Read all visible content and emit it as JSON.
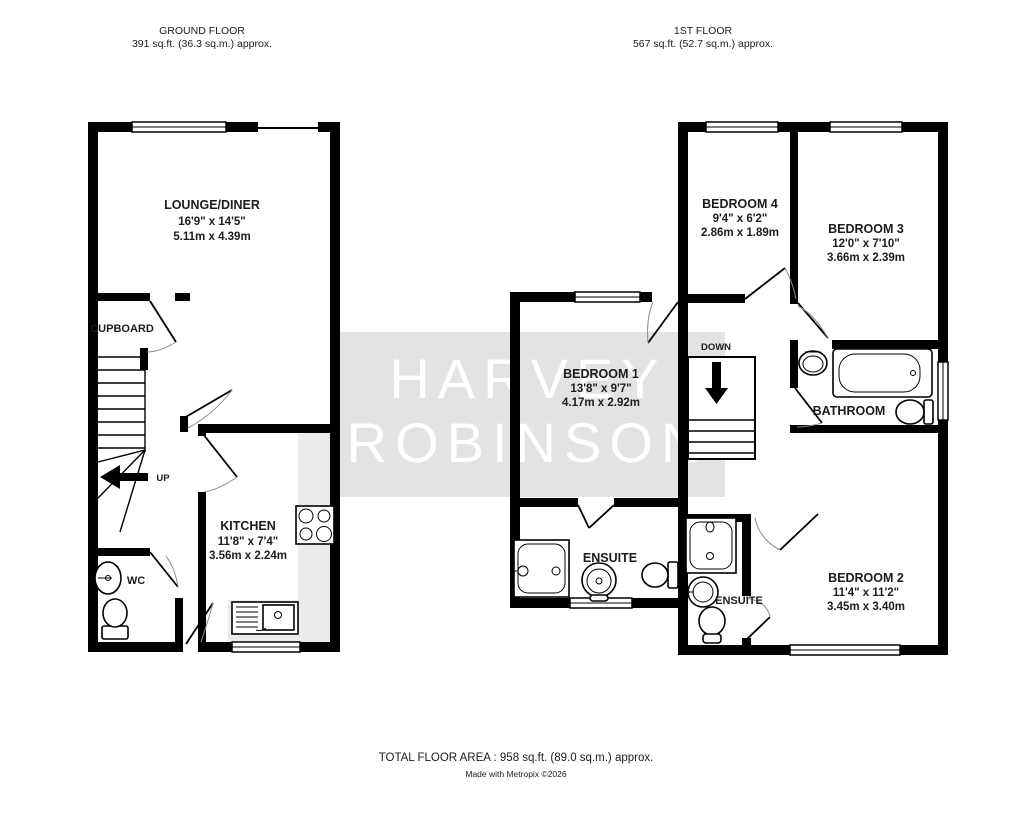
{
  "ground_floor": {
    "title": "GROUND FLOOR",
    "area": "391 sq.ft. (36.3 sq.m.) approx.",
    "stairs_label": "UP",
    "rooms": {
      "lounge_diner": {
        "name": "LOUNGE/DINER",
        "imperial": "16'9\"  x 14'5\"",
        "metric": "5.11m  x 4.39m"
      },
      "cupboard": {
        "name": "CUPBOARD"
      },
      "kitchen": {
        "name": "KITCHEN",
        "imperial": "11'8\"  x 7'4\"",
        "metric": "3.56m  x 2.24m"
      },
      "wc": {
        "name": "WC"
      }
    }
  },
  "first_floor": {
    "title": "1ST FLOOR",
    "area": "567 sq.ft. (52.7 sq.m.) approx.",
    "stairs_label": "DOWN",
    "rooms": {
      "bedroom1": {
        "name": "BEDROOM 1",
        "imperial": "13'8\"  x 9'7\"",
        "metric": "4.17m  x 2.92m"
      },
      "bedroom2": {
        "name": "BEDROOM 2",
        "imperial": "11'4\"  x 11'2\"",
        "metric": "3.45m  x 3.40m"
      },
      "bedroom3": {
        "name": "BEDROOM 3",
        "imperial": "12'0\"  x 7'10\"",
        "metric": "3.66m  x 2.39m"
      },
      "bedroom4": {
        "name": "BEDROOM 4",
        "imperial": "9'4\"  x 6'2\"",
        "metric": "2.86m  x 1.89m"
      },
      "bathroom": {
        "name": "BATHROOM"
      },
      "ensuite_bed1": {
        "name": "ENSUITE"
      },
      "ensuite_bed2": {
        "name": "ENSUITE"
      }
    }
  },
  "watermark": {
    "line1": "HARVEY",
    "line2": "ROBINSON"
  },
  "footer": {
    "total_area": "TOTAL FLOOR AREA : 958 sq.ft. (89.0 sq.m.) approx.",
    "credit": "Made with Metropix ©2026"
  },
  "colors": {
    "wall": "#000000",
    "counter": "#ebebeb",
    "watermark_box": "#e3e3e3",
    "watermark_text": "#ffffff",
    "text": "#1c1c1c"
  }
}
